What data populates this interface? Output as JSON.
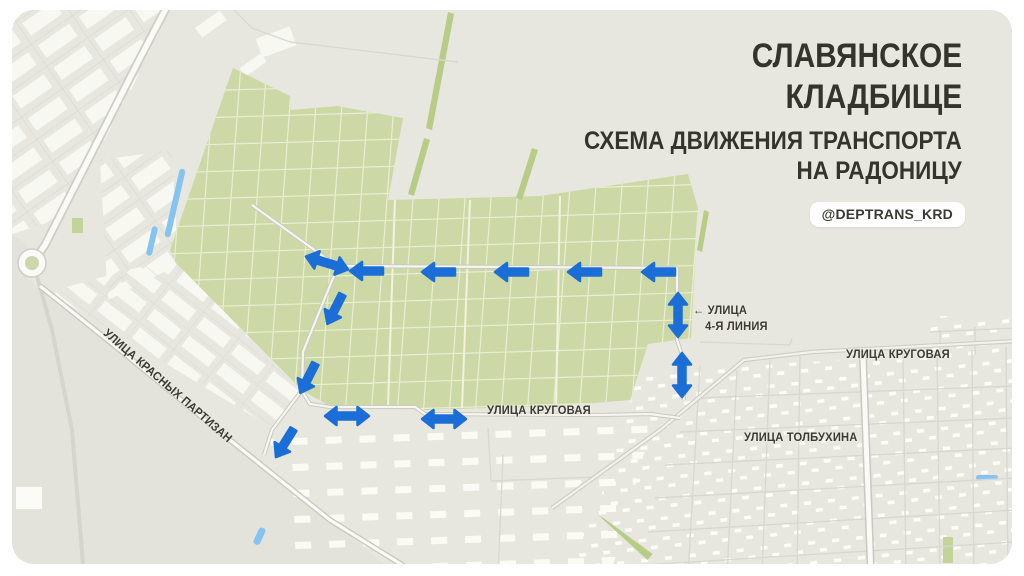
{
  "header": {
    "title_line1": "СЛАВЯНСКОЕ",
    "title_line2": "КЛАДБИЩЕ",
    "subtitle_line1": "СХЕМА ДВИЖЕНИЯ ТРАНСПОРТА",
    "subtitle_line2": "НА РАДОНИЦУ",
    "handle_badge": "@DEPTRANS_KRD"
  },
  "map": {
    "street_labels": {
      "krasnykh_partizan": "УЛИЦА КРАСНЫХ ПАРТИЗАН",
      "krugovaya_center": "УЛИЦА КРУГОВАЯ",
      "krugovaya_right": "УЛИЦА КРУГОВАЯ",
      "tolbukhina": "УЛИЦА ТОЛБУХИНА",
      "liniya4_line1": "← УЛИЦА",
      "liniya4_line2": "4-Я ЛИНИЯ"
    },
    "colors": {
      "page_bg": "#ffffff",
      "map_base": "#e8e7df",
      "lowland": "#e3e3dc",
      "cemetery_green": "#ccd8a5",
      "cemetery_grid": "#eaeed3",
      "tree_green": "#b7cc86",
      "road_fill": "#fafaf6",
      "road_casing": "#cecec7",
      "street_line": "#d8d8d2",
      "building": "#f8f8f3",
      "water": "#85c3f0",
      "arrow_blue": "#1b6ed8",
      "label_text": "#3b3b36",
      "title_text": "#34342f"
    },
    "arrows": [
      {
        "type": "double",
        "direction": "two-way-diagonal",
        "x": 327,
        "y": 263,
        "rot": 17
      },
      {
        "type": "single",
        "direction": "left",
        "x": 369,
        "y": 271,
        "rot": 0
      },
      {
        "type": "single",
        "direction": "left",
        "x": 441,
        "y": 272,
        "rot": 0
      },
      {
        "type": "single",
        "direction": "left",
        "x": 514,
        "y": 272,
        "rot": 0
      },
      {
        "type": "single",
        "direction": "left",
        "x": 587,
        "y": 272,
        "rot": 0
      },
      {
        "type": "single",
        "direction": "left",
        "x": 661,
        "y": 272,
        "rot": 0
      },
      {
        "type": "single",
        "direction": "down-left",
        "x": 336,
        "y": 307,
        "rot": -63
      },
      {
        "type": "double",
        "direction": "two-way-vertical",
        "x": 678,
        "y": 315,
        "rot": 90
      },
      {
        "type": "double",
        "direction": "two-way-vertical",
        "x": 682,
        "y": 375,
        "rot": 90
      },
      {
        "type": "single",
        "direction": "down-left",
        "x": 309,
        "y": 376,
        "rot": -63
      },
      {
        "type": "single",
        "direction": "down-left",
        "x": 286,
        "y": 441,
        "rot": -58
      },
      {
        "type": "double",
        "direction": "two-way-horizontal",
        "x": 347,
        "y": 416,
        "rot": 0
      },
      {
        "type": "double",
        "direction": "two-way-horizontal",
        "x": 444,
        "y": 419,
        "rot": 0
      }
    ]
  }
}
